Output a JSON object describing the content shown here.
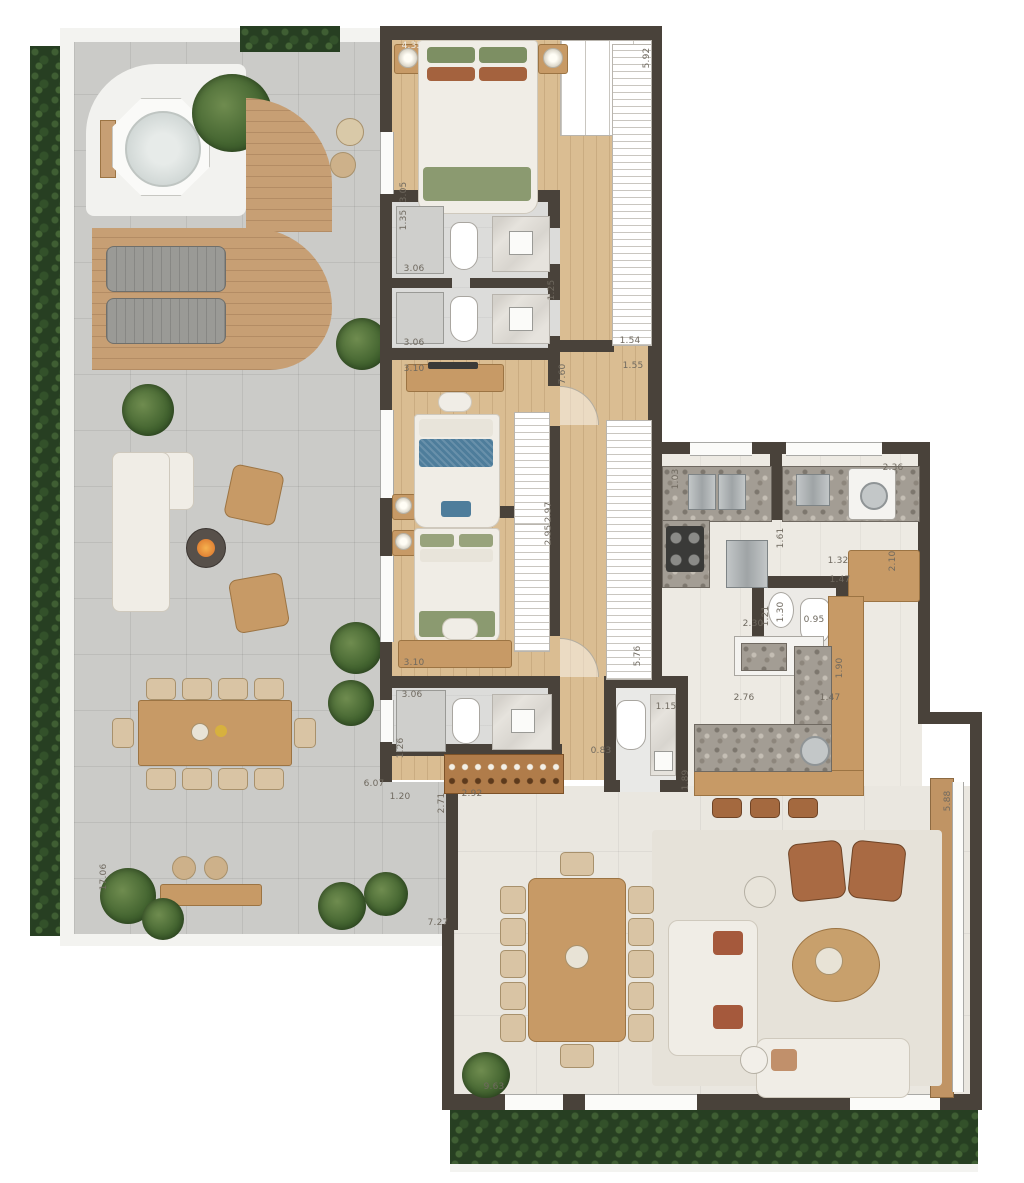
{
  "canvas": {
    "width": 1024,
    "height": 1183
  },
  "palette": {
    "wall": "#49423a",
    "wood_floor": "#dabd92",
    "deck_wood": "#c79f74",
    "terrace_pavers": "#cbcbc8",
    "hedge_green": "#273f22",
    "living_tile": "#eae7e0",
    "terrazzo_counter": "#a39d94",
    "island_wood": "#c79a66",
    "sofa_white": "#f0ede6",
    "accent_rust": "#a5593c",
    "accent_green": "#8b9a70",
    "accent_blue": "#4e7d9b"
  },
  "dimensions": [
    {
      "label": "4.35",
      "x": 412,
      "y": 46,
      "rot": 0,
      "light": true
    },
    {
      "label": "5.92",
      "x": 647,
      "y": 58,
      "rot": -90
    },
    {
      "label": "3.05",
      "x": 404,
      "y": 192,
      "rot": -90
    },
    {
      "label": "1.35",
      "x": 404,
      "y": 220,
      "rot": -90
    },
    {
      "label": "3.06",
      "x": 414,
      "y": 269,
      "rot": 0
    },
    {
      "label": "1.25",
      "x": 552,
      "y": 290,
      "rot": -90
    },
    {
      "label": "3.06",
      "x": 414,
      "y": 343,
      "rot": 0
    },
    {
      "label": "1.54",
      "x": 630,
      "y": 341,
      "rot": 0
    },
    {
      "label": "1.55",
      "x": 633,
      "y": 366,
      "rot": 0
    },
    {
      "label": "7.60",
      "x": 563,
      "y": 374,
      "rot": -90
    },
    {
      "label": "3.10",
      "x": 414,
      "y": 369,
      "rot": 0
    },
    {
      "label": "2.97",
      "x": 549,
      "y": 512,
      "rot": -90
    },
    {
      "label": "2.95",
      "x": 549,
      "y": 535,
      "rot": -90
    },
    {
      "label": "3.10",
      "x": 414,
      "y": 663,
      "rot": 0
    },
    {
      "label": "3.06",
      "x": 412,
      "y": 695,
      "rot": 0
    },
    {
      "label": "1.26",
      "x": 401,
      "y": 748,
      "rot": -90
    },
    {
      "label": "6.07",
      "x": 374,
      "y": 784,
      "rot": 0
    },
    {
      "label": "1.20",
      "x": 400,
      "y": 797,
      "rot": 0
    },
    {
      "label": "2.71",
      "x": 442,
      "y": 803,
      "rot": -90
    },
    {
      "label": "2.92",
      "x": 472,
      "y": 794,
      "rot": 0
    },
    {
      "label": "0.83",
      "x": 601,
      "y": 751,
      "rot": 0
    },
    {
      "label": "1.15",
      "x": 666,
      "y": 707,
      "rot": 0
    },
    {
      "label": "1.89",
      "x": 686,
      "y": 780,
      "rot": -90
    },
    {
      "label": "5.76",
      "x": 638,
      "y": 656,
      "rot": -90
    },
    {
      "label": "1.03",
      "x": 676,
      "y": 479,
      "rot": -90
    },
    {
      "label": "2.36",
      "x": 893,
      "y": 468,
      "rot": 0
    },
    {
      "label": "1.61",
      "x": 781,
      "y": 538,
      "rot": -90
    },
    {
      "label": "1.32",
      "x": 838,
      "y": 561,
      "rot": 0
    },
    {
      "label": "2.10",
      "x": 893,
      "y": 561,
      "rot": -90
    },
    {
      "label": "1.47",
      "x": 840,
      "y": 580,
      "rot": 0
    },
    {
      "label": "1.30",
      "x": 781,
      "y": 612,
      "rot": -90
    },
    {
      "label": "1.21",
      "x": 766,
      "y": 616,
      "rot": -90
    },
    {
      "label": "0.95",
      "x": 814,
      "y": 620,
      "rot": 0
    },
    {
      "label": "2.30",
      "x": 753,
      "y": 624,
      "rot": 0
    },
    {
      "label": "1.90",
      "x": 840,
      "y": 668,
      "rot": -90
    },
    {
      "label": "2.76",
      "x": 744,
      "y": 698,
      "rot": 0
    },
    {
      "label": "1.47",
      "x": 830,
      "y": 698,
      "rot": 0
    },
    {
      "label": "17.06",
      "x": 104,
      "y": 877,
      "rot": -90
    },
    {
      "label": "7.27",
      "x": 438,
      "y": 923,
      "rot": 0
    },
    {
      "label": "9.63",
      "x": 494,
      "y": 1087,
      "rot": 0
    },
    {
      "label": "5.88",
      "x": 948,
      "y": 801,
      "rot": -90
    }
  ]
}
